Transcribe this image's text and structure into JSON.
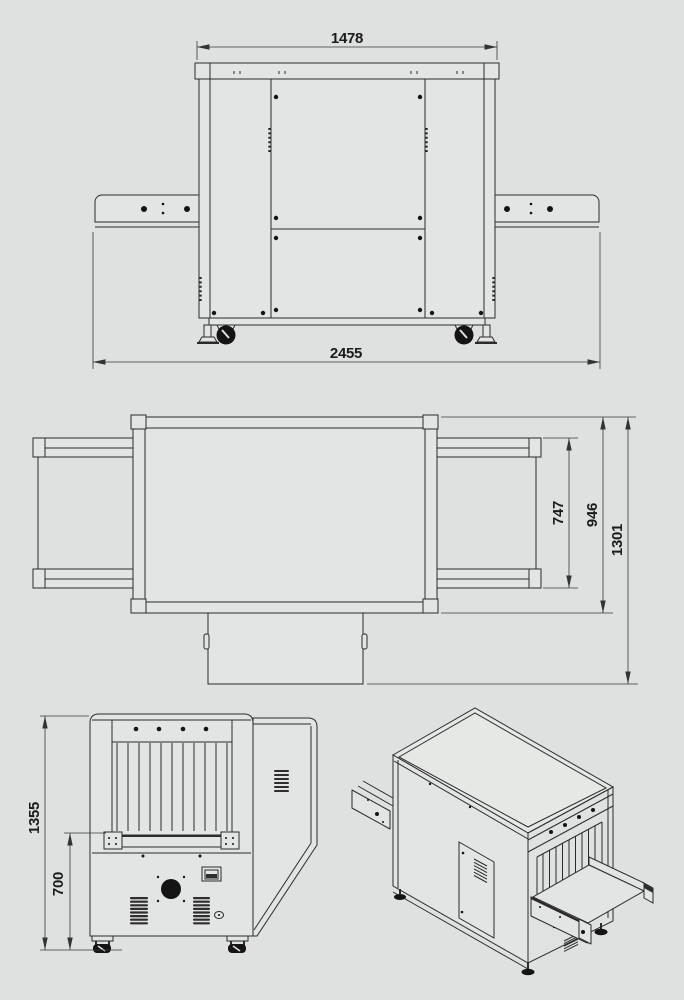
{
  "page": {
    "background_color": "#dee1df",
    "line_color": "#2b2b2b",
    "text_color": "#1b1b1b"
  },
  "drawing": {
    "type": "technical-dimensional-drawing",
    "views": {
      "front_elevation": {
        "dims": {
          "top_width": "1478",
          "overall_length": "2455"
        }
      },
      "top_plan": {
        "dims": {
          "conveyor_width": "747",
          "body_depth": "946",
          "overall_depth": "1301"
        }
      },
      "end_elevation": {
        "dims": {
          "overall_height": "1355",
          "belt_height": "700"
        }
      },
      "isometric": {}
    }
  }
}
